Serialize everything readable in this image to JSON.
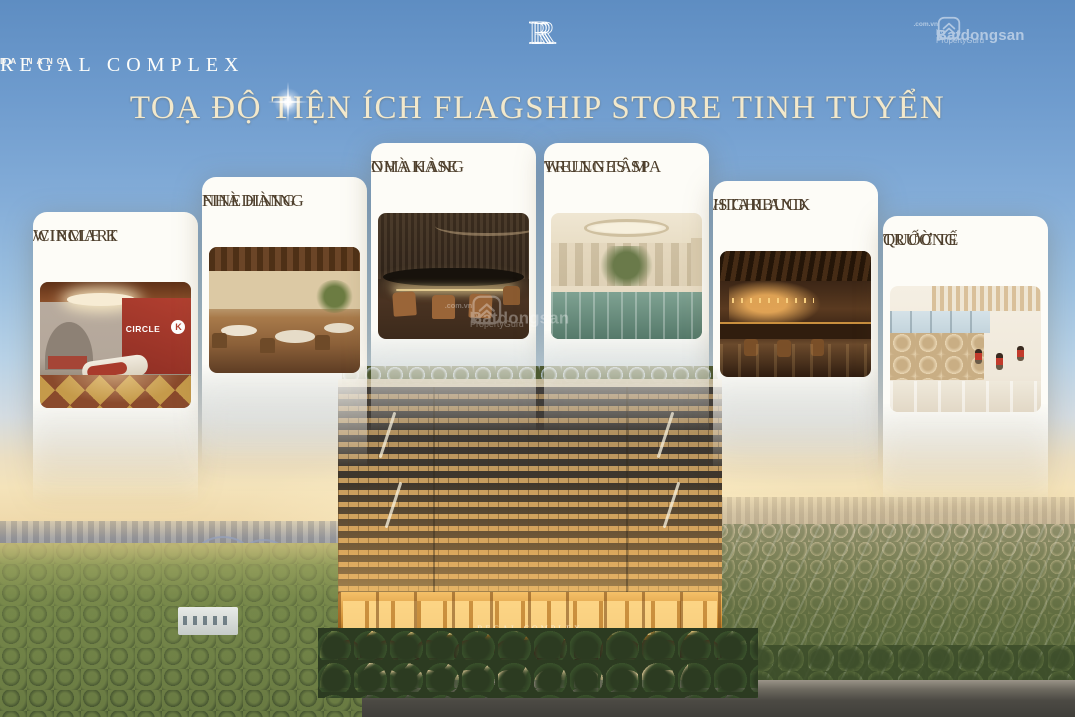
{
  "logo": {
    "monogram": "R",
    "title": "REGAL COMPLEX",
    "subtitle": "DA NANG"
  },
  "headline": {
    "text": "TOẠ ĐỘ TIỆN ÍCH FLAGSHIP STORE TINH TUYỂN"
  },
  "watermark": {
    "brand": "Batdongsan",
    "domain": ".com.vn",
    "byline": "by PropertyGuru",
    "icon": "house-chevron-icon"
  },
  "cards": [
    {
      "label_line1": "WINMART",
      "label_line2": "/CIRCLE K",
      "photo": "circle-k-convenience-store-render",
      "photo_text": "CIRCLE",
      "photo_logo_letter": "K"
    },
    {
      "label_line1": "NHÀ HÀNG",
      "label_line2": "FINEDINING",
      "photo": "fine-dining-restaurant-interior"
    },
    {
      "label_line1": "NHÀ HÀNG",
      "label_line2": "OMAKASE",
      "photo": "omakase-restaurant-counter"
    },
    {
      "label_line1": "TRUNG TÂM",
      "label_line2": "WELLNES SPA",
      "photo": "wellness-spa-indoor-pool"
    },
    {
      "label_line1": "HIGHLAND",
      "label_line2": "/STARBUCK",
      "photo": "coffee-shop-interior"
    },
    {
      "label_line1": "TRƯỜNG",
      "label_line2": "QUỐC TẾ",
      "photo": "international-school-corridor"
    }
  ],
  "building": {
    "signage": "REGAL COMPLEX"
  },
  "colors": {
    "sky_top": "#5e8dc2",
    "horizon": "#f2e0ba",
    "headline_text": "#f2e8cb",
    "card_bg": "#fdfcf7",
    "card_text": "#4e3f2c",
    "building_gold": "#d3a55c",
    "circle_k_red": "#b23f30",
    "watermark_white": "#ffffff"
  }
}
